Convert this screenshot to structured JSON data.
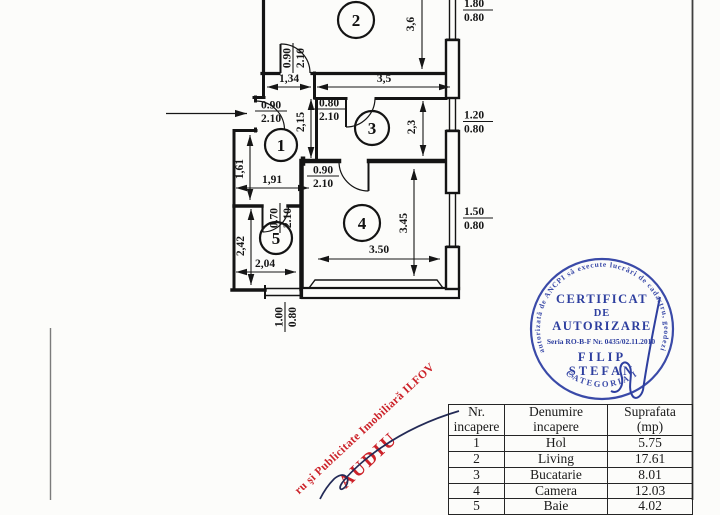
{
  "colors": {
    "ink": "#161616",
    "stamp_blue": "#2e3f9f",
    "stamp_red": "#cc2229",
    "signature_navy": "#232a56"
  },
  "plan": {
    "rooms": {
      "r1": "1",
      "r2": "2",
      "r3": "3",
      "r4": "4",
      "r5": "5"
    },
    "dims": {
      "d_134": "1,34",
      "d_35": "3,5",
      "d_36": "3,6",
      "d_23": "2,3",
      "d_215": "2,15",
      "d_161": "1,61",
      "d_191": "1,91",
      "d_242": "2,42",
      "d_204": "2,04",
      "d_350": "3.50",
      "d_345": "3.45"
    },
    "doors": {
      "living": {
        "w": "0.90",
        "h": "2.10"
      },
      "entry": {
        "w": "0.90",
        "h": "2.10"
      },
      "kitchen": {
        "w": "0.80",
        "h": "2.10"
      },
      "camera": {
        "w": "0.90",
        "h": "2.10"
      },
      "room5": {
        "w": "0.70",
        "h": "2.10"
      }
    },
    "windows": {
      "w1": {
        "w": "1.80",
        "h": "0.80"
      },
      "w2": {
        "w": "1.20",
        "h": "0.80"
      },
      "w3": {
        "w": "1.50",
        "h": "0.80"
      },
      "w4": {
        "w": "1.00",
        "h": "0.80"
      }
    }
  },
  "stamp": {
    "ring_text": "autorizată de ANCPI să execute lucrări de cadastru, geodezie",
    "bottom_text": "CATEGORIA I",
    "line1": "CERTIFICAT",
    "line2": "DE",
    "line3": "AUTORIZARE",
    "serial": "Seria RO-B-F Nr. 0435/02.11.2010",
    "name1": "FILIP",
    "name2": "ŞTEFAN"
  },
  "red_stamp": {
    "line1": "ru şi Publicitate Imobiliară ILFOV",
    "line2": "AUDIU"
  },
  "table": {
    "headers": {
      "col1a": "Nr.",
      "col1b": "incapere",
      "col2a": "Denumire",
      "col2b": "incapere",
      "col3a": "Suprafata",
      "col3b": "(mp)"
    },
    "rows": [
      {
        "nr": "1",
        "name": "Hol",
        "area": "5.75"
      },
      {
        "nr": "2",
        "name": "Living",
        "area": "17.61"
      },
      {
        "nr": "3",
        "name": "Bucatarie",
        "area": "8.01"
      },
      {
        "nr": "4",
        "name": "Camera",
        "area": "12.03"
      },
      {
        "nr": "5",
        "name": "Baie",
        "area": "4.02"
      }
    ]
  }
}
